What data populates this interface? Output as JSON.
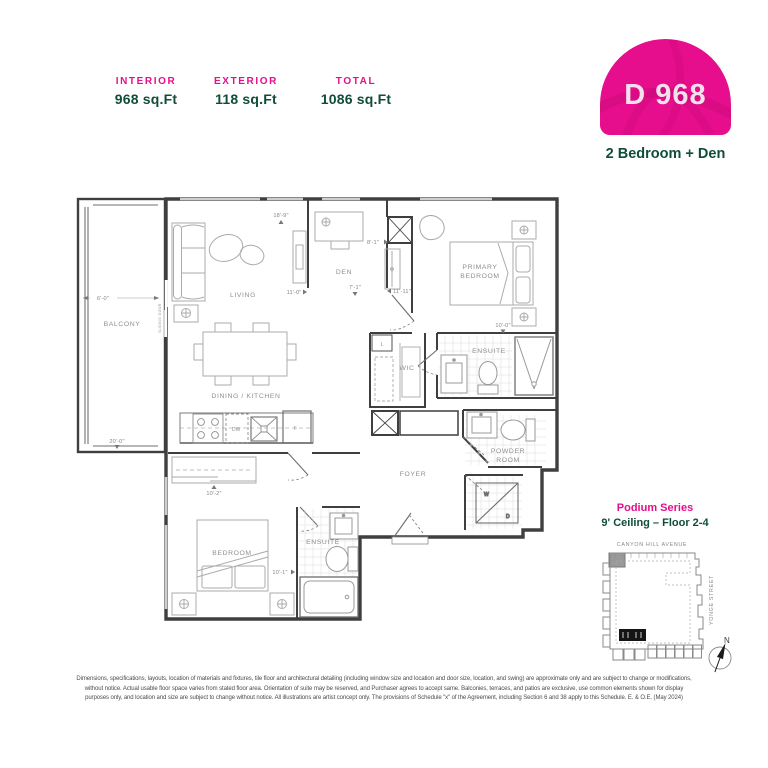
{
  "header": {
    "stats": [
      {
        "label": "INTERIOR",
        "value": "968 sq.Ft"
      },
      {
        "label": "EXTERIOR",
        "value": "118 sq.Ft"
      },
      {
        "label": "TOTAL",
        "value": "1086 sq.Ft"
      }
    ],
    "unit_code": "D 968",
    "unit_type": "2 Bedroom + Den"
  },
  "colors": {
    "accent": "#E60E8C",
    "green": "#0F4D38",
    "wall": "#3F3F3F",
    "furniture": "#ABABAB",
    "label": "#8F8F8F"
  },
  "plan": {
    "rooms": {
      "balcony": "BALCONY",
      "living": "LIVING",
      "den": "DEN",
      "primary_line1": "PRIMARY",
      "primary_line2": "BEDROOM",
      "wic": "WIC",
      "linen": "L",
      "ensuite_primary": "ENSUITE",
      "dining_kitchen": "DINING / KITCHEN",
      "powder_line1": "POWDER",
      "powder_line2": "ROOM",
      "foyer": "FOYER",
      "bedroom": "BEDROOM",
      "ensuite_bedroom": "ENSUITE"
    },
    "fixtures": {
      "dishwasher": "DW",
      "fridge": "F",
      "washer": "W",
      "dryer": "D",
      "sliding_door": "SLIDING DOOR"
    },
    "dims": {
      "balcony_width": "6'-0\"",
      "balcony_length": "20'-0\"",
      "living_width": "18'-9\"",
      "living_depth": "11'-0\"",
      "den_depth": "8'-1\"",
      "den_width": "7'-1\"",
      "primary_width": "11'-11\"",
      "primary_depth": "10'-0\"",
      "bedroom_width": "10'-2\"",
      "bedroom_depth": "10'-1\""
    }
  },
  "keyplan": {
    "series": "Podium Series",
    "ceiling": "9' Ceiling – Floor 2-4",
    "street_top": "CANYON HILL AVENUE",
    "street_right": "YONGE STREET",
    "north": "N"
  },
  "disclaimer": [
    "Dimensions, specifications, layouts, location of materials and fixtures, tile floor and architectural detailing (including window size and location and door size, location, and swing) are approximate only and are subject to change or modifications,",
    "without notice. Actual usable floor space varies from stated floor area. Orientation of suite may be reserved, and Purchaser agrees to accept same. Balconies, terraces, and patios are exclusive, use common elements shown for display",
    "purposes only, and location and size are subject to change without notice. All illustrations are artist concept only. The provisions of Schedule \"x\" of the Agreement, including Section 6 and 38 apply to this Schedule. E. & O.E. (May 2024)"
  ]
}
